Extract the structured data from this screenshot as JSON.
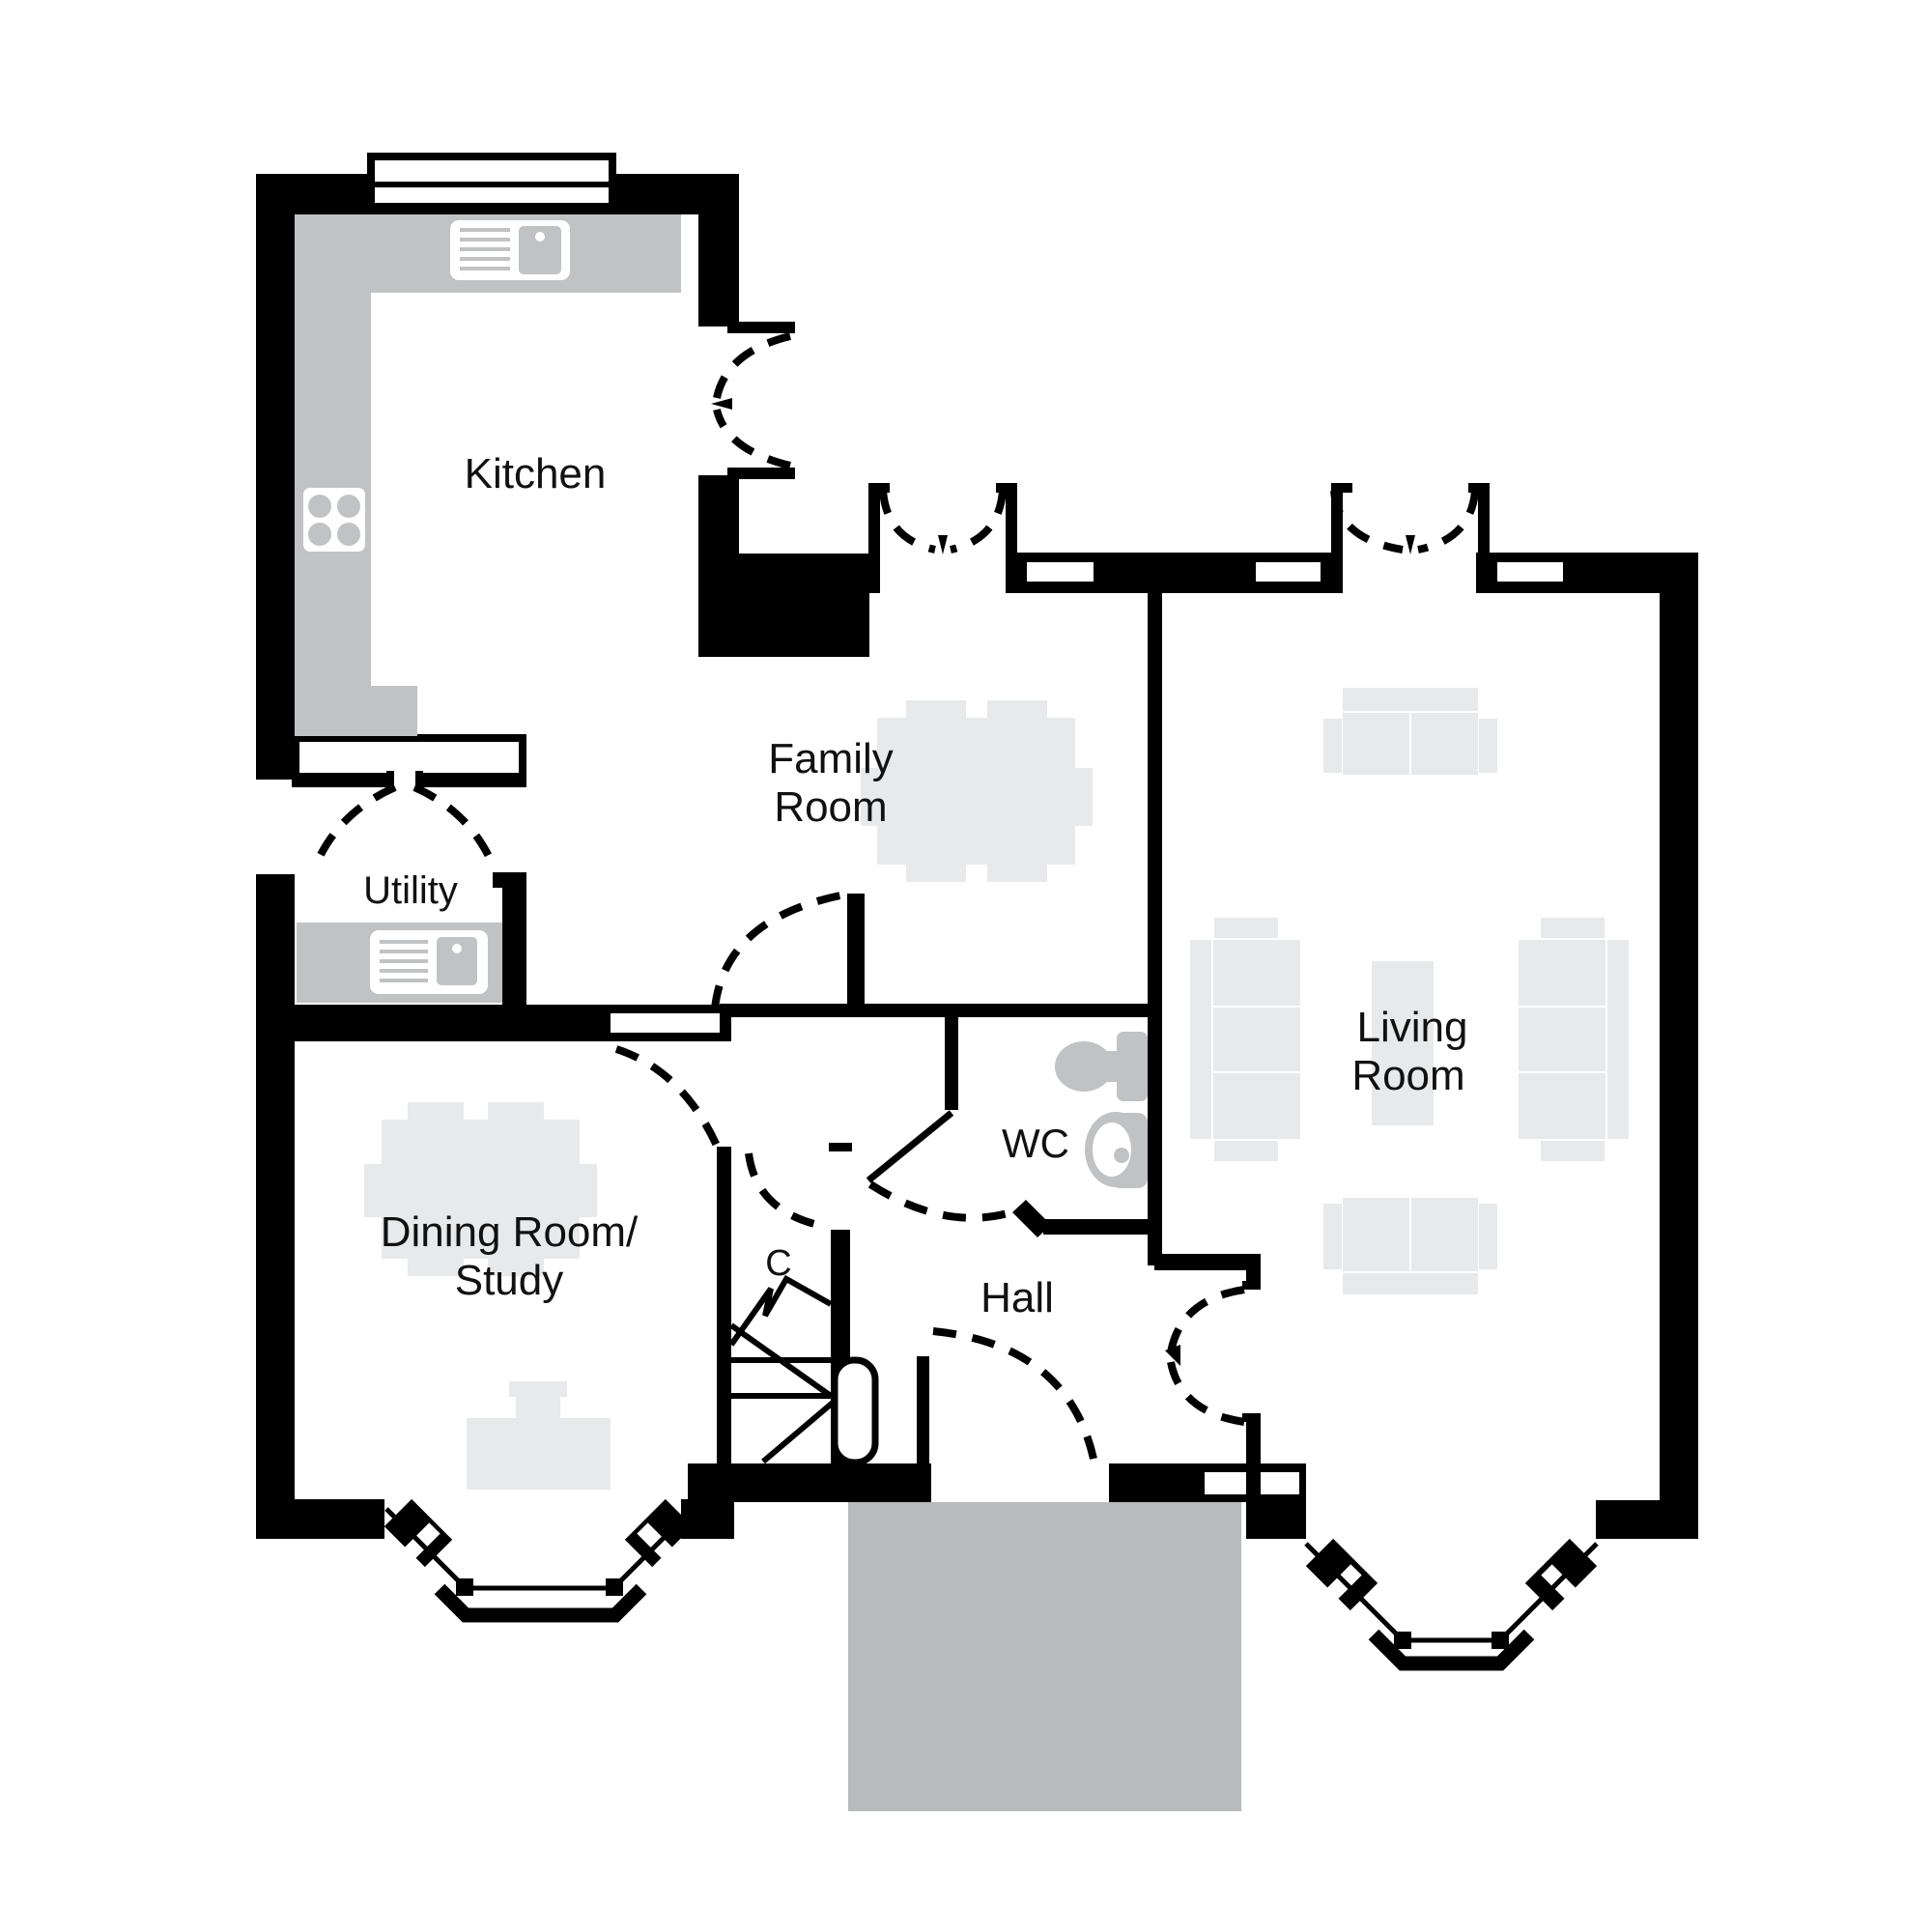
{
  "title": "Ground floor plan",
  "rooms": {
    "kitchen": {
      "label": "Kitchen"
    },
    "family": {
      "line1": "Family",
      "line2": "Room"
    },
    "utility": {
      "label": "Utility"
    },
    "dining": {
      "line1": "Dining Room/",
      "line2": "Study"
    },
    "cupboard": {
      "label": "C"
    },
    "hall": {
      "label": "Hall"
    },
    "wc": {
      "label": "WC"
    },
    "living": {
      "line1": "Living",
      "line2": "Room"
    }
  },
  "colors": {
    "wall": "#000000",
    "furniture": "#e8e9ea",
    "fixture": "#c1c2c3",
    "porch": "#b9babb",
    "text": "#111111",
    "bg": "#ffffff"
  }
}
